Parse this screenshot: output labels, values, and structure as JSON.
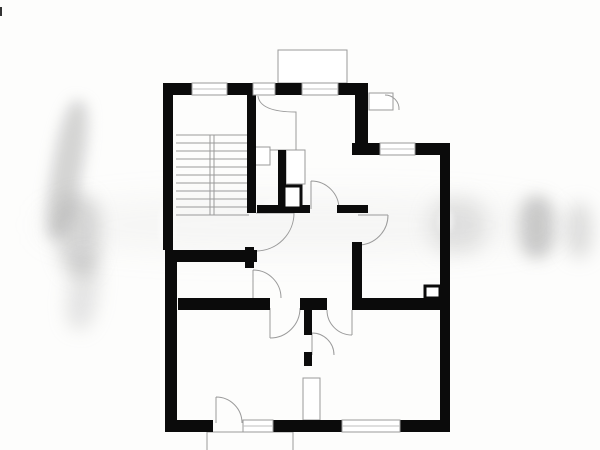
{
  "canvas": {
    "width": 600,
    "height": 450,
    "background": "#fdfdfc",
    "wall_color": "#0b0b0b",
    "line_color": "#9a9a9a",
    "light_line_color": "#bfbfbf",
    "window_fill": "#ffffff"
  },
  "floorplan": {
    "walls": [
      {
        "name": "top-wall-seg-1",
        "x": 163,
        "y": 83,
        "w": 29,
        "h": 12
      },
      {
        "name": "top-wall-seg-2",
        "x": 227,
        "y": 83,
        "w": 26,
        "h": 12
      },
      {
        "name": "top-wall-seg-3",
        "x": 275,
        "y": 83,
        "w": 27,
        "h": 12
      },
      {
        "name": "top-wall-seg-4",
        "x": 338,
        "y": 83,
        "w": 30,
        "h": 12
      },
      {
        "name": "left-outer-wall-upper",
        "x": 163,
        "y": 83,
        "w": 10,
        "h": 167
      },
      {
        "name": "stair-bath-divider-wall",
        "x": 247,
        "y": 95,
        "w": 9,
        "h": 118
      },
      {
        "name": "upper-right-divider-wall",
        "x": 355,
        "y": 83,
        "w": 13,
        "h": 72
      },
      {
        "name": "bath-inner-wall",
        "x": 278,
        "y": 150,
        "w": 8,
        "h": 63
      },
      {
        "name": "hall-top-wall-seg-1",
        "x": 257,
        "y": 205,
        "w": 53,
        "h": 8
      },
      {
        "name": "hall-top-wall-seg-2",
        "x": 337,
        "y": 205,
        "w": 31,
        "h": 8
      },
      {
        "name": "stair-bottom-thick-wall",
        "x": 165,
        "y": 250,
        "w": 92,
        "h": 12
      },
      {
        "name": "left-outer-wall-lower",
        "x": 165,
        "y": 250,
        "w": 12,
        "h": 182
      },
      {
        "name": "hall-left-wall-seg-1",
        "x": 245,
        "y": 247,
        "w": 9,
        "h": 21
      },
      {
        "name": "small-room-bottom-wall",
        "x": 178,
        "y": 298,
        "w": 92,
        "h": 12
      },
      {
        "name": "hall-bottom-wall-seg",
        "x": 300,
        "y": 298,
        "w": 27,
        "h": 12
      },
      {
        "name": "right-room-bottom-wall",
        "x": 352,
        "y": 298,
        "w": 88,
        "h": 12
      },
      {
        "name": "hall-right-wall",
        "x": 352,
        "y": 242,
        "w": 10,
        "h": 58
      },
      {
        "name": "topright-top-wall-seg-1",
        "x": 352,
        "y": 143,
        "w": 28,
        "h": 12
      },
      {
        "name": "topright-top-wall-seg-2",
        "x": 415,
        "y": 143,
        "w": 35,
        "h": 12
      },
      {
        "name": "right-outer-wall",
        "x": 440,
        "y": 143,
        "w": 10,
        "h": 289
      },
      {
        "name": "bottom-rooms-divider-stub-1",
        "x": 304,
        "y": 310,
        "w": 8,
        "h": 25
      },
      {
        "name": "bottom-rooms-divider-stub-2",
        "x": 304,
        "y": 352,
        "w": 8,
        "h": 14
      },
      {
        "name": "bottom-wall-seg-1",
        "x": 165,
        "y": 420,
        "w": 48,
        "h": 12
      },
      {
        "name": "bottom-wall-seg-2",
        "x": 273,
        "y": 420,
        "w": 69,
        "h": 12
      },
      {
        "name": "bottom-wall-seg-3",
        "x": 400,
        "y": 420,
        "w": 47,
        "h": 12
      }
    ],
    "windows": [
      {
        "name": "stairwell-window",
        "x": 192,
        "y": 83,
        "w": 35,
        "h": 12
      },
      {
        "name": "top-window-small",
        "x": 253,
        "y": 83,
        "w": 22,
        "h": 12
      },
      {
        "name": "balcony-door-window",
        "x": 302,
        "y": 83,
        "w": 36,
        "h": 12
      },
      {
        "name": "topright-room-window",
        "x": 380,
        "y": 143,
        "w": 35,
        "h": 12
      },
      {
        "name": "bottom-window",
        "x": 342,
        "y": 420,
        "w": 58,
        "h": 12
      },
      {
        "name": "terrace-sidelight-window",
        "x": 243,
        "y": 420,
        "w": 30,
        "h": 12
      }
    ],
    "thin_shapes": [
      {
        "name": "balcony-outline",
        "x": 278,
        "y": 50,
        "w": 69,
        "h": 33
      },
      {
        "name": "neighbor-niche-outline",
        "x": 369,
        "y": 93,
        "w": 24,
        "h": 17
      },
      {
        "name": "bath-fixture-outline",
        "x": 286,
        "y": 150,
        "w": 19,
        "h": 34
      },
      {
        "name": "wardrobe-outline",
        "x": 303,
        "y": 378,
        "w": 17,
        "h": 42
      },
      {
        "name": "vestibule-closet-outline",
        "x": 253,
        "y": 147,
        "w": 17,
        "h": 18
      }
    ],
    "thick_boxes": [
      {
        "name": "shaft-box",
        "x": 284,
        "y": 186,
        "w": 17,
        "h": 22
      },
      {
        "name": "chimney-box",
        "x": 425,
        "y": 286,
        "w": 15,
        "h": 12
      }
    ],
    "stairs": {
      "name": "staircase",
      "x1": 176,
      "x2": 249,
      "y_start": 135,
      "tread_step": 8,
      "tread_count": 11,
      "divider_x1": 210,
      "divider_x2": 214,
      "y_top": 135,
      "y_bottom": 215
    },
    "door_paths": [
      {
        "name": "entrance-door-swing",
        "d": "M256,213 L294,213 M294,213 A38,38 0 0 1 256,251"
      },
      {
        "name": "small-room-door-swing",
        "d": "M253,298 L253,270 M253,270 A28,28 0 0 1 281,298"
      },
      {
        "name": "bathroom-door-swing",
        "d": "M311,209 L311,181 M311,181 A28,28 0 0 1 339,209"
      },
      {
        "name": "topright-room-door-swing",
        "d": "M358,215 L388,215 M388,215 A30,30 0 0 1 358,245"
      },
      {
        "name": "bottomleft-room-door-swing",
        "d": "M270,308 L270,338 M300,308 A30,30 0 0 1 270,338"
      },
      {
        "name": "bottomright-room-door-swing",
        "d": "M352,310 L352,335 M327,310 A25,25 0 0 0 352,335"
      },
      {
        "name": "between-rooms-door-swing",
        "d": "M312,333 L312,355 M312,333 A22,22 0 0 1 334,355"
      },
      {
        "name": "terrace-door-swing",
        "d": "M216,397 L216,423 M216,397 A26,26 0 0 1 242,423"
      },
      {
        "name": "vestibule-curved-wall",
        "d": "M258,96 Q260,112 296,112 L296,150 L270,150"
      },
      {
        "name": "neighbor-door-swing",
        "d": "M385,95 A14,14 0 0 1 399,110"
      },
      {
        "name": "terrace-outline",
        "d": "M207,450 L207,432 L293,432 L293,450"
      }
    ]
  },
  "watermark": {
    "blobs": [
      {
        "name": "watermark-smudge-left-1",
        "x": 52,
        "y": 100,
        "w": 30,
        "h": 140,
        "rot": 10,
        "color": "rgba(150,150,150,0.40)",
        "blur": 7
      },
      {
        "name": "watermark-smudge-left-2",
        "x": 58,
        "y": 195,
        "w": 42,
        "h": 80,
        "rot": 0,
        "color": "rgba(130,130,130,0.30)",
        "blur": 9
      },
      {
        "name": "watermark-smudge-left-3",
        "x": 68,
        "y": 255,
        "w": 30,
        "h": 75,
        "rot": 8,
        "color": "rgba(160,160,160,0.26)",
        "blur": 9
      },
      {
        "name": "watermark-smudge-mid",
        "x": 430,
        "y": 198,
        "w": 55,
        "h": 55,
        "rot": 0,
        "color": "rgba(165,165,165,0.28)",
        "blur": 10
      },
      {
        "name": "watermark-smudge-right-1",
        "x": 520,
        "y": 196,
        "w": 34,
        "h": 62,
        "rot": 0,
        "color": "rgba(120,120,120,0.38)",
        "blur": 8
      },
      {
        "name": "watermark-smudge-right-2",
        "x": 566,
        "y": 203,
        "w": 26,
        "h": 55,
        "rot": 0,
        "color": "rgba(150,150,150,0.30)",
        "blur": 9
      },
      {
        "name": "watermark-band",
        "x": 40,
        "y": 195,
        "w": 520,
        "h": 60,
        "rot": 0,
        "color": "rgba(190,190,190,0.10)",
        "blur": 14
      },
      {
        "name": "watermark-wall-fade-1",
        "x": 159,
        "y": 206,
        "w": 16,
        "h": 40,
        "rot": 0,
        "color": "rgba(255,255,255,0.55)",
        "blur": 3
      },
      {
        "name": "watermark-wall-fade-2",
        "x": 439,
        "y": 210,
        "w": 14,
        "h": 22,
        "rot": 0,
        "color": "rgba(255,255,255,0.50)",
        "blur": 3
      },
      {
        "name": "watermark-wall-fade-3",
        "x": 264,
        "y": 200,
        "w": 20,
        "h": 14,
        "rot": 0,
        "color": "rgba(255,255,255,0.50)",
        "blur": 3
      }
    ]
  },
  "artifacts": [
    {
      "name": "left-edge-mark",
      "x": 0,
      "y": 7,
      "w": 2,
      "h": 9,
      "color": "#333333"
    }
  ]
}
